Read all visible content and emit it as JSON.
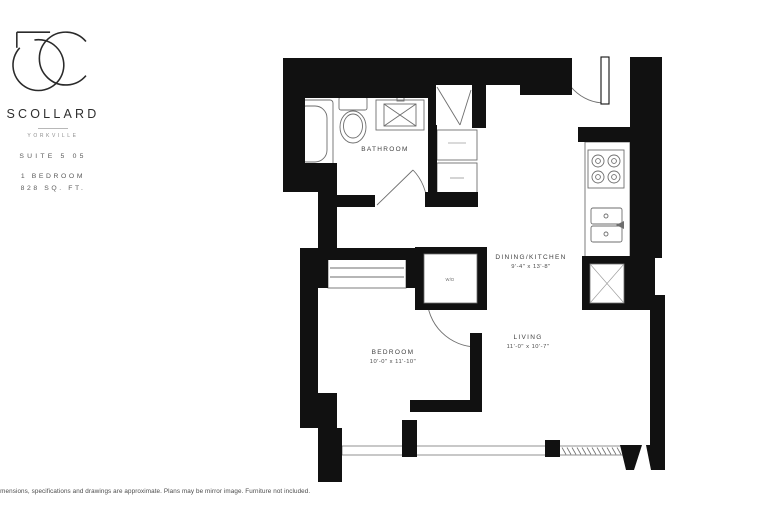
{
  "branding": {
    "monogram": "5C",
    "name": "SCOLLARD",
    "location": "YORKVILLE",
    "suite": "SUITE 5 05",
    "unit_type": "1 BEDROOM",
    "unit_area": "828 SQ. FT."
  },
  "floor_plan": {
    "rooms": {
      "bathroom": {
        "label": "BATHROOM"
      },
      "dining_kitchen": {
        "label": "DINING/KITCHEN",
        "dimensions": "9'-4\" x 13'-8\""
      },
      "bedroom": {
        "label": "BEDROOM",
        "dimensions": "10'-0\" x 11'-10\""
      },
      "living": {
        "label": "LIVING",
        "dimensions": "11'-0\" x 10'-7\""
      },
      "laundry_closet": {
        "label": "W/D"
      }
    }
  },
  "footer": {
    "disclaimer": "Dimensions, specifications and drawings are approximate. Plans may be mirror image. Furniture not included."
  },
  "colors": {
    "wall": "#111111",
    "line": "#6e6e6e",
    "label_text": "#3f3f3f"
  }
}
